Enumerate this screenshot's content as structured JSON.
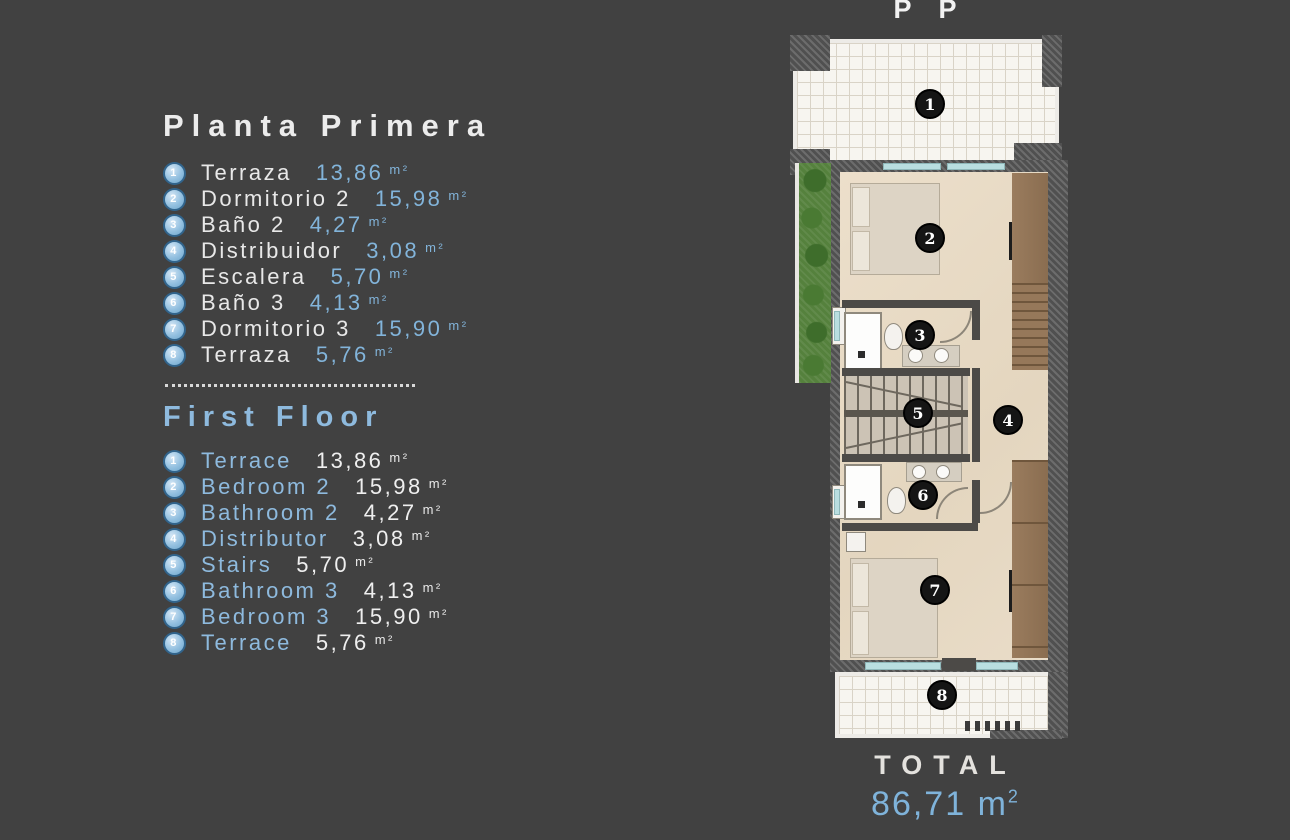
{
  "background": "#414141",
  "accent_blue": "#7fb3da",
  "pp_label": "P P",
  "legend_es": {
    "title": "Planta Primera",
    "items": [
      {
        "num": "1",
        "label": "Terraza",
        "value": "13,86",
        "unit": "m²"
      },
      {
        "num": "2",
        "label": "Dormitorio 2",
        "value": "15,98",
        "unit": "m²"
      },
      {
        "num": "3",
        "label": "Baño 2",
        "value": "4,27",
        "unit": "m²"
      },
      {
        "num": "4",
        "label": "Distribuidor",
        "value": "3,08",
        "unit": "m²"
      },
      {
        "num": "5",
        "label": "Escalera",
        "value": "5,70",
        "unit": "m²"
      },
      {
        "num": "6",
        "label": "Baño 3",
        "value": "4,13",
        "unit": "m²"
      },
      {
        "num": "7",
        "label": "Dormitorio 3",
        "value": "15,90",
        "unit": "m²"
      },
      {
        "num": "8",
        "label": "Terraza",
        "value": "5,76",
        "unit": "m²"
      }
    ]
  },
  "legend_en": {
    "title": "First Floor",
    "items": [
      {
        "num": "1",
        "label": "Terrace",
        "value": "13,86",
        "unit": "m²"
      },
      {
        "num": "2",
        "label": "Bedroom 2",
        "value": "15,98",
        "unit": "m²"
      },
      {
        "num": "3",
        "label": "Bathroom 2",
        "value": "4,27",
        "unit": "m²"
      },
      {
        "num": "4",
        "label": "Distributor",
        "value": "3,08",
        "unit": "m²"
      },
      {
        "num": "5",
        "label": "Stairs",
        "value": "5,70",
        "unit": "m²"
      },
      {
        "num": "6",
        "label": "Bathroom 3",
        "value": "4,13",
        "unit": "m²"
      },
      {
        "num": "7",
        "label": "Bedroom 3",
        "value": "15,90",
        "unit": "m²"
      },
      {
        "num": "8",
        "label": "Terrace",
        "value": "5,76",
        "unit": "m²"
      }
    ]
  },
  "floorplan": {
    "markers": [
      "1",
      "2",
      "3",
      "4",
      "5",
      "6",
      "7",
      "8"
    ]
  },
  "total": {
    "label": "TOTAL",
    "value": "86,71",
    "unit": "m",
    "sup": "2"
  }
}
